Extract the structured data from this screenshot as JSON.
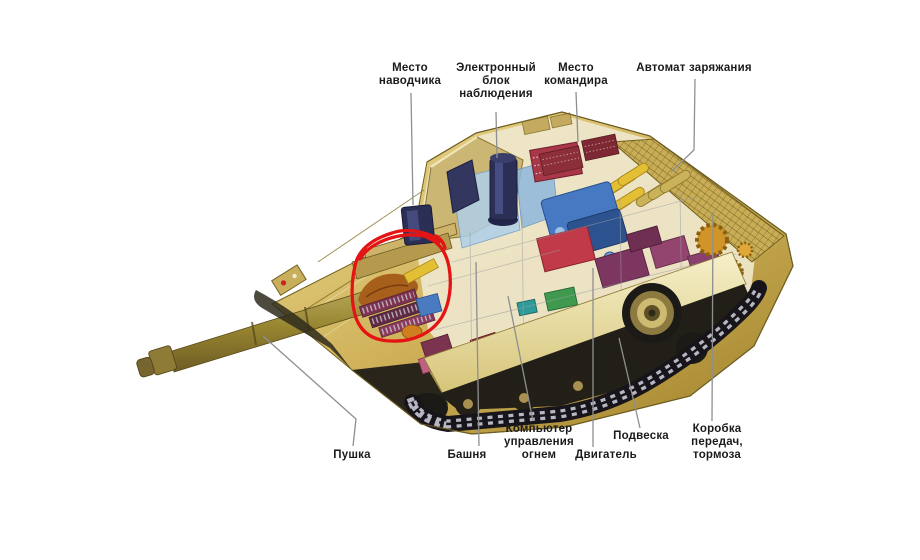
{
  "figure": {
    "subject": "tank cutaway diagram",
    "background_color": "#ffffff",
    "label_text_color": "#1b1b1b",
    "leader_line_color": "#8f8f8f",
    "annotation_circle_color": "#e41414"
  },
  "callouts": {
    "gunner_position": {
      "lines": [
        "Место",
        "наводчика"
      ]
    },
    "surveillance_unit": {
      "lines": [
        "Электронный",
        "блок",
        "наблюдения"
      ]
    },
    "commander_position": {
      "lines": [
        "Место",
        "командира"
      ]
    },
    "autoloader": {
      "lines": [
        "Автомат заряжания"
      ]
    },
    "gun": {
      "lines": [
        "Пушка"
      ]
    },
    "turret": {
      "lines": [
        "Башня"
      ]
    },
    "fire_control_computer": {
      "lines": [
        "Компьютер",
        "управления",
        "огнем"
      ]
    },
    "engine": {
      "lines": [
        "Двигатель"
      ]
    },
    "suspension": {
      "lines": [
        "Подвеска"
      ]
    },
    "gearbox_brakes": {
      "lines": [
        "Коробка",
        "передач,",
        "тормоза"
      ]
    }
  }
}
